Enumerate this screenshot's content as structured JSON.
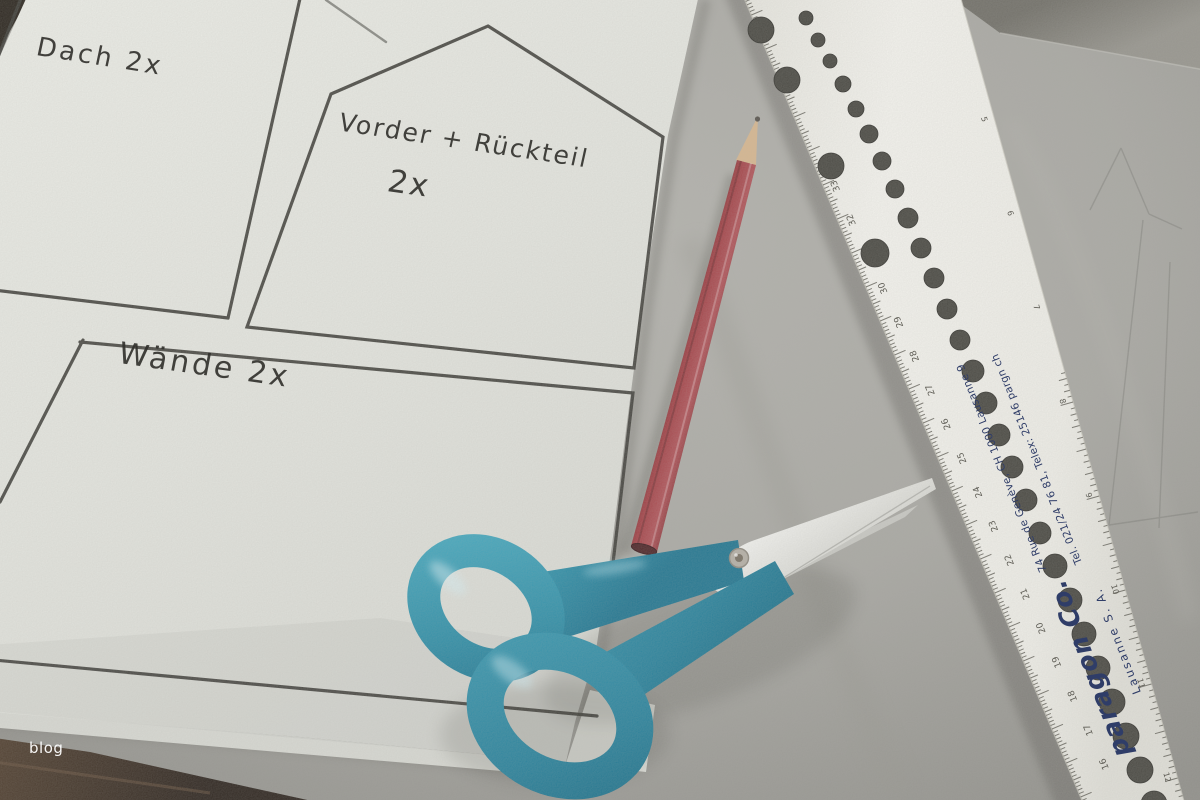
{
  "scene": {
    "objects": [
      {
        "name": "white-pattern-sheet"
      },
      {
        "name": "gray-craft-paper"
      },
      {
        "name": "red-pencil"
      },
      {
        "name": "teal-scissors"
      },
      {
        "name": "white-lettering-ruler"
      },
      {
        "name": "wood-table"
      }
    ]
  },
  "labels": {
    "roof": "Dach 2x",
    "front_back_line1": "Vorder + Rückteil",
    "front_back_line2": "2x",
    "walls": "Wände 2x"
  },
  "ruler": {
    "brand": "paragon Co.",
    "company": "Lausanne  S. A.",
    "address": "74 Rue de Genève, CH 1000 Lausanne 9",
    "contact": "Tel. 021/24 76 81, Telex: 25146 pargn ch",
    "cm_numbers": [
      16,
      17,
      18,
      19,
      20,
      21,
      22,
      23,
      24,
      25,
      26,
      27,
      28,
      29,
      30,
      31,
      32,
      33
    ],
    "inch_numbers": [
      5,
      6,
      7,
      8,
      9,
      10,
      11,
      12
    ]
  },
  "watermark": "blog",
  "colors": {
    "background_paper": "#abaaa5",
    "white_paper": "#e9eae4",
    "table_wood": "#302820",
    "marker_line": "#3b3a35",
    "handwriting": "#302f2b",
    "pencil_red": "#9c3a3f",
    "pencil_wood": "#d8b78f",
    "scissors_teal": "#2b90aa",
    "blade_silver": "#eef0ed",
    "ruler_body": "#f4f3ee",
    "ruler_navy": "#2f3d68",
    "tick_gray": "#4c4a42",
    "watermark": "#ffffff"
  }
}
